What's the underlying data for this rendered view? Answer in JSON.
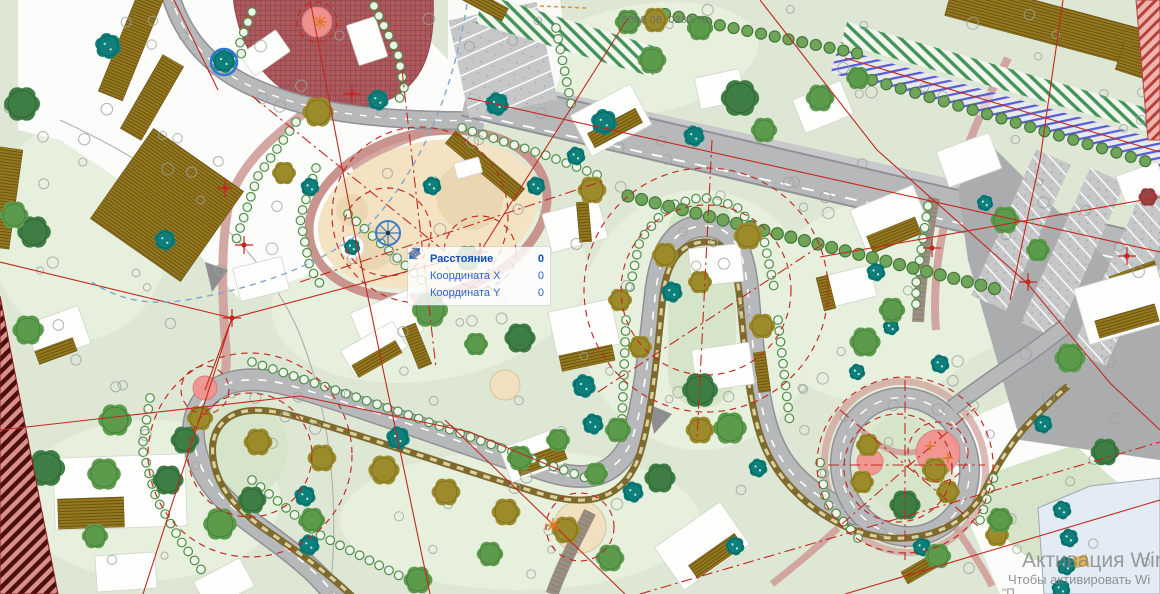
{
  "app": {
    "view": "site-plan-viewport"
  },
  "status": {
    "cursor_readout": "5068.08, 0237.70"
  },
  "tooltip": {
    "rows": [
      {
        "icon": "distance-icon",
        "label": "Расстояние",
        "value": "0"
      },
      {
        "icon": "coordinate-x-icon",
        "label": "Координата X",
        "value": "0"
      },
      {
        "icon": "coordinate-y-icon",
        "label": "Координата Y",
        "value": "0"
      }
    ]
  },
  "watermark": {
    "line1": "Активация Windows",
    "line2": "Чтобы активировать Wi",
    "line3": "\"П"
  },
  "colors": {
    "background": "#dde7d4",
    "lawn_light": "#e7efdd",
    "lawn_dark": "#d6e4ca",
    "road": "#b7b8ba",
    "track_brown": "#7d6a2c",
    "red_line": "#c4281f",
    "tooltip_blue": "#0f4fb8",
    "sand": "#f3e3c3",
    "playground": "#ad5a5e",
    "pink_pad": "#f2938f",
    "teal_tree": "#0d807c",
    "olive_tree": "#9c8b2b",
    "green_tree": "#5c9a4c",
    "watermark_gray": "#808080"
  },
  "map": {
    "trees": [
      [
        108,
        46,
        11,
        "te"
      ],
      [
        224,
        61,
        10,
        "te"
      ],
      [
        165,
        240,
        9,
        "te"
      ],
      [
        310,
        187,
        8,
        "te"
      ],
      [
        378,
        100,
        9,
        "te"
      ],
      [
        432,
        186,
        8,
        "te"
      ],
      [
        497,
        104,
        10,
        "te"
      ],
      [
        536,
        186,
        8,
        "te"
      ],
      [
        576,
        156,
        8,
        "te"
      ],
      [
        604,
        122,
        11,
        "te"
      ],
      [
        694,
        136,
        9,
        "te"
      ],
      [
        672,
        292,
        9,
        "te"
      ],
      [
        584,
        386,
        10,
        "te"
      ],
      [
        398,
        438,
        10,
        "te"
      ],
      [
        305,
        496,
        9,
        "te"
      ],
      [
        309,
        545,
        9,
        "te"
      ],
      [
        593,
        424,
        9,
        "te"
      ],
      [
        633,
        492,
        9,
        "te"
      ],
      [
        876,
        272,
        8,
        "te"
      ],
      [
        891,
        327,
        7,
        "te"
      ],
      [
        857,
        372,
        7,
        "te"
      ],
      [
        985,
        203,
        7,
        "te"
      ],
      [
        940,
        364,
        8,
        "te"
      ],
      [
        1043,
        424,
        8,
        "te"
      ],
      [
        758,
        468,
        8,
        "te"
      ],
      [
        735,
        546,
        8,
        "te"
      ],
      [
        922,
        547,
        8,
        "te"
      ],
      [
        1062,
        510,
        8,
        "te"
      ],
      [
        1069,
        538,
        8,
        "te"
      ],
      [
        1066,
        566,
        8,
        "te"
      ],
      [
        1061,
        589,
        8,
        "te"
      ],
      [
        352,
        247,
        7,
        "te"
      ],
      [
        318,
        112,
        13,
        "ol"
      ],
      [
        284,
        173,
        10,
        "ol"
      ],
      [
        592,
        190,
        12,
        "ol"
      ],
      [
        665,
        255,
        11,
        "ol"
      ],
      [
        620,
        300,
        10,
        "ol"
      ],
      [
        700,
        282,
        10,
        "ol"
      ],
      [
        748,
        236,
        12,
        "ol"
      ],
      [
        762,
        326,
        11,
        "ol"
      ],
      [
        640,
        347,
        10,
        "ol"
      ],
      [
        700,
        430,
        12,
        "ol"
      ],
      [
        200,
        418,
        11,
        "ol"
      ],
      [
        258,
        442,
        12,
        "ol"
      ],
      [
        322,
        458,
        12,
        "ol"
      ],
      [
        384,
        470,
        13,
        "ol"
      ],
      [
        446,
        492,
        12,
        "ol"
      ],
      [
        506,
        512,
        12,
        "ol"
      ],
      [
        566,
        530,
        12,
        "ol"
      ],
      [
        868,
        445,
        10,
        "ol"
      ],
      [
        935,
        470,
        11,
        "ol"
      ],
      [
        862,
        482,
        10,
        "ol"
      ],
      [
        948,
        492,
        10,
        "ol"
      ],
      [
        997,
        535,
        10,
        "ol"
      ],
      [
        655,
        20,
        11,
        "ol"
      ],
      [
        22,
        104,
        15,
        "dg"
      ],
      [
        34,
        232,
        14,
        "dg"
      ],
      [
        14,
        215,
        12,
        "gr"
      ],
      [
        28,
        330,
        13,
        "gr"
      ],
      [
        46,
        468,
        16,
        "dg"
      ],
      [
        104,
        474,
        14,
        "gr"
      ],
      [
        168,
        480,
        13,
        "dg"
      ],
      [
        220,
        524,
        14,
        "gr"
      ],
      [
        252,
        500,
        12,
        "dg"
      ],
      [
        312,
        520,
        11,
        "gr"
      ],
      [
        418,
        580,
        12,
        "gr"
      ],
      [
        95,
        536,
        11,
        "gr"
      ],
      [
        115,
        420,
        14,
        "gr"
      ],
      [
        185,
        440,
        12,
        "dg"
      ],
      [
        628,
        22,
        11,
        "gr"
      ],
      [
        652,
        60,
        12,
        "gr"
      ],
      [
        700,
        28,
        11,
        "gr"
      ],
      [
        740,
        98,
        16,
        "dg"
      ],
      [
        764,
        130,
        11,
        "gr"
      ],
      [
        820,
        98,
        12,
        "gr"
      ],
      [
        858,
        78,
        10,
        "gr"
      ],
      [
        430,
        310,
        15,
        "gr"
      ],
      [
        468,
        258,
        11,
        "gr"
      ],
      [
        520,
        338,
        13,
        "dg"
      ],
      [
        476,
        344,
        10,
        "gr"
      ],
      [
        618,
        430,
        11,
        "gr"
      ],
      [
        700,
        390,
        15,
        "dg"
      ],
      [
        730,
        428,
        14,
        "gr"
      ],
      [
        660,
        478,
        13,
        "dg"
      ],
      [
        610,
        558,
        12,
        "gr"
      ],
      [
        490,
        554,
        11,
        "gr"
      ],
      [
        520,
        458,
        11,
        "gr"
      ],
      [
        558,
        440,
        10,
        "gr"
      ],
      [
        596,
        474,
        10,
        "gr"
      ],
      [
        1005,
        220,
        12,
        "gr"
      ],
      [
        1038,
        250,
        10,
        "gr"
      ],
      [
        1070,
        358,
        13,
        "gr"
      ],
      [
        1105,
        452,
        12,
        "dg"
      ],
      [
        865,
        342,
        13,
        "gr"
      ],
      [
        892,
        310,
        11,
        "gr"
      ],
      [
        905,
        505,
        13,
        "dg"
      ],
      [
        938,
        556,
        11,
        "gr"
      ],
      [
        1000,
        520,
        11,
        "gr"
      ],
      [
        1148,
        197,
        8,
        "mr"
      ]
    ],
    "buildings": [
      [
        243,
        40,
        44,
        26,
        -35
      ],
      [
        352,
        20,
        30,
        42,
        -18
      ],
      [
        577,
        97,
        68,
        46,
        -28
      ],
      [
        697,
        73,
        46,
        32,
        -12
      ],
      [
        797,
        89,
        52,
        36,
        -22
      ],
      [
        546,
        206,
        58,
        40,
        -15
      ],
      [
        856,
        196,
        68,
        46,
        -22
      ],
      [
        941,
        141,
        56,
        38,
        -20
      ],
      [
        1080,
        276,
        86,
        58,
        -16
      ],
      [
        356,
        300,
        62,
        44,
        -22
      ],
      [
        552,
        305,
        64,
        46,
        -12
      ],
      [
        690,
        246,
        52,
        38,
        -6
      ],
      [
        694,
        346,
        58,
        42,
        -8
      ],
      [
        236,
        262,
        50,
        34,
        -14
      ],
      [
        30,
        314,
        56,
        40,
        -20
      ],
      [
        54,
        456,
        132,
        72,
        -2
      ],
      [
        344,
        334,
        60,
        30,
        -30
      ],
      [
        504,
        438,
        56,
        36,
        -20
      ],
      [
        662,
        520,
        80,
        52,
        -35
      ],
      [
        96,
        554,
        60,
        36,
        -4
      ],
      [
        198,
        568,
        52,
        32,
        -28
      ],
      [
        828,
        270,
        46,
        32,
        -14
      ],
      [
        1120,
        168,
        44,
        32,
        -20
      ],
      [
        455,
        160,
        26,
        16,
        -15
      ]
    ],
    "roofs": [
      [
        588,
        120,
        54,
        16,
        -28
      ],
      [
        868,
        226,
        52,
        18,
        -22
      ],
      [
        1096,
        312,
        62,
        18,
        -16
      ],
      [
        410,
        324,
        14,
        44,
        -22
      ],
      [
        560,
        350,
        54,
        16,
        -12
      ],
      [
        36,
        344,
        40,
        14,
        -20
      ],
      [
        58,
        498,
        66,
        30,
        -2
      ],
      [
        352,
        352,
        50,
        14,
        -30
      ],
      [
        516,
        452,
        50,
        16,
        -20
      ],
      [
        688,
        548,
        56,
        16,
        -35
      ],
      [
        820,
        276,
        12,
        34,
        -14
      ],
      [
        578,
        202,
        12,
        40,
        -5
      ],
      [
        756,
        352,
        12,
        40,
        -8
      ],
      [
        902,
        562,
        36,
        14,
        -30
      ]
    ],
    "big_strips": [
      [
        118,
        -10,
        26,
        110,
        22
      ],
      [
        140,
        55,
        24,
        85,
        30
      ],
      [
        -8,
        148,
        24,
        100,
        8
      ],
      [
        112,
        150,
        110,
        110,
        35
      ],
      [
        946,
        6,
        216,
        38,
        15
      ],
      [
        1118,
        52,
        64,
        28,
        18
      ],
      [
        1112,
        268,
        48,
        26,
        -20
      ],
      [
        458,
        -4,
        50,
        14,
        28
      ],
      [
        440,
        158,
        90,
        16,
        40
      ]
    ],
    "shrub_rows": [
      {
        "pts": [
          [
            252,
            362
          ],
          [
            400,
            412
          ],
          [
            535,
            460
          ],
          [
            592,
            480
          ]
        ],
        "sp": 11
      },
      {
        "pts": [
          [
            150,
            398
          ],
          [
            142,
            448
          ],
          [
            156,
            498
          ],
          [
            180,
            540
          ],
          [
            205,
            575
          ]
        ],
        "sp": 11
      },
      {
        "pts": [
          [
            630,
            287
          ],
          [
            640,
            240
          ],
          [
            668,
            206
          ],
          [
            702,
            197
          ],
          [
            736,
            206
          ],
          [
            764,
            240
          ],
          [
            774,
            287
          ]
        ],
        "sp": 11
      },
      {
        "pts": [
          [
            626,
            320
          ],
          [
            622,
            420
          ]
        ],
        "sp": 11
      },
      {
        "pts": [
          [
            778,
            320
          ],
          [
            790,
            424
          ]
        ],
        "sp": 11
      },
      {
        "pts": [
          [
            316,
            168
          ],
          [
            300,
            218
          ],
          [
            310,
            268
          ],
          [
            324,
            290
          ]
        ],
        "sp": 11
      },
      {
        "pts": [
          [
            374,
            6
          ],
          [
            398,
            54
          ],
          [
            404,
            88
          ],
          [
            396,
            106
          ]
        ],
        "sp": 11
      },
      {
        "pts": [
          [
            252,
            12
          ],
          [
            240,
            42
          ],
          [
            242,
            60
          ]
        ],
        "sp": 11
      },
      {
        "pts": [
          [
            296,
            122
          ],
          [
            258,
            176
          ],
          [
            236,
            240
          ]
        ],
        "sp": 11
      },
      {
        "pts": [
          [
            556,
            28
          ],
          [
            572,
            108
          ]
        ],
        "sp": 11
      },
      {
        "pts": [
          [
            348,
            214
          ],
          [
            424,
            282
          ]
        ],
        "sp": 11
      },
      {
        "pts": [
          [
            928,
            206
          ],
          [
            916,
            284
          ],
          [
            916,
            312
          ]
        ],
        "sp": 11
      },
      {
        "pts": [
          [
            858,
            538
          ],
          [
            826,
            502
          ],
          [
            820,
            462
          ]
        ],
        "sp": 11
      },
      {
        "pts": [
          [
            980,
            520
          ],
          [
            996,
            470
          ]
        ],
        "sp": 11
      },
      {
        "pts": [
          [
            252,
            480
          ],
          [
            318,
            534
          ],
          [
            400,
            576
          ]
        ],
        "sp": 11
      },
      {
        "pts": [
          [
            462,
            128
          ],
          [
            548,
            156
          ],
          [
            600,
            176
          ]
        ],
        "sp": 11
      }
    ],
    "street_rows": [
      {
        "pts": [
          [
            628,
            196
          ],
          [
            1000,
            290
          ]
        ],
        "sp": 14,
        "r": 6
      },
      {
        "pts": [
          [
            872,
            80
          ],
          [
            1148,
            162
          ]
        ],
        "sp": 15,
        "r": 5.5
      },
      {
        "pts": [
          [
            665,
            14
          ],
          [
            860,
            54
          ]
        ],
        "sp": 14,
        "r": 5.5
      }
    ],
    "scatter": {
      "count": 160,
      "seed": 987654321
    },
    "red_lines": [
      {
        "d": "M310,0 L355,235 L430,594",
        "t": "s"
      },
      {
        "d": "M628,18 L480,252 L232,318",
        "t": "s"
      },
      {
        "d": "M232,318 L0,262",
        "t": "s"
      },
      {
        "d": "M232,318 L143,594",
        "t": "s"
      },
      {
        "d": "M0,430 L300,396 L470,432 L560,470",
        "t": "s"
      },
      {
        "d": "M468,98 L1160,252",
        "t": "s"
      },
      {
        "d": "M845,58 L1160,152",
        "t": "s"
      },
      {
        "d": "M760,0 L877,150 L1027,283 L1110,383 L1160,430",
        "t": "s"
      },
      {
        "d": "M1063,0 L1040,160 L1010,300",
        "t": "s"
      },
      {
        "d": "M820,257 L1160,197",
        "t": "s"
      },
      {
        "d": "M845,594 L1160,500",
        "t": "s"
      },
      {
        "d": "M174,0 L218,90",
        "t": "s"
      },
      {
        "d": "M445,420 L625,594",
        "t": "s"
      },
      {
        "d": "M205,390 L232,318",
        "t": "s"
      },
      {
        "d": "M640,594 L1160,442",
        "t": "dd"
      },
      {
        "d": "M712,140 L697,440",
        "t": "dd"
      },
      {
        "d": "M598,392 L826,242",
        "t": "dd"
      },
      {
        "d": "M252,96 L505,300",
        "t": "dd"
      },
      {
        "d": "M300,282 L606,180",
        "t": "dd"
      },
      {
        "d": "M402,70 L436,368",
        "t": "dd"
      },
      {
        "d": "M905,380 L905,560",
        "t": "dd"
      },
      {
        "d": "M828,465 L985,465",
        "t": "dd"
      },
      {
        "d": "M840,410 L978,526",
        "t": "dd"
      },
      {
        "d": "M842,524 L975,408",
        "t": "dd"
      }
    ],
    "red_circles": [
      [
        420,
        215,
        88
      ],
      [
        387,
        232,
        44
      ],
      [
        706,
        290,
        85
      ],
      [
        706,
        290,
        122
      ],
      [
        905,
        465,
        88
      ],
      [
        898,
        468,
        54
      ],
      [
        938,
        452,
        30
      ],
      [
        250,
        455,
        62
      ],
      [
        250,
        455,
        102
      ],
      [
        205,
        390,
        24
      ],
      [
        580,
        527,
        34
      ],
      [
        317,
        22,
        20
      ],
      [
        480,
        252,
        36
      ]
    ],
    "markers": [
      [
        232,
        318
      ],
      [
        480,
        252
      ],
      [
        932,
        248
      ],
      [
        1028,
        282
      ],
      [
        1127,
        256
      ],
      [
        225,
        188
      ],
      [
        244,
        245
      ],
      [
        352,
        94
      ]
    ],
    "orange_markers": [
      [
        553,
        525
      ],
      [
        320,
        22
      ]
    ],
    "orange_plus": [
      [
        930,
        446
      ],
      [
        948,
        458
      ]
    ],
    "pink_pads": [
      [
        317,
        22,
        15
      ],
      [
        205,
        388,
        12
      ],
      [
        870,
        462,
        13
      ],
      [
        938,
        452,
        22
      ]
    ]
  }
}
